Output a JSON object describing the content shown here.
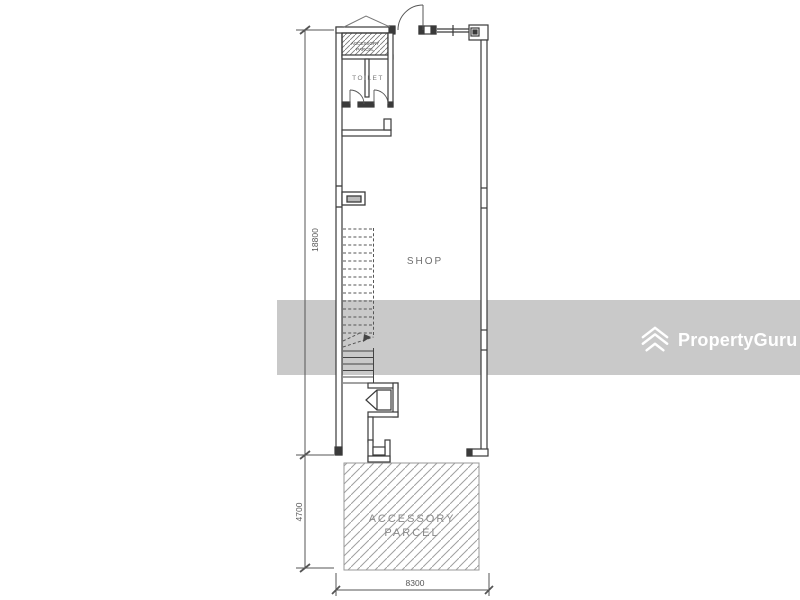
{
  "watermark": {
    "brand": "PropertyGuru",
    "band_color": "#c9c9c9",
    "logo_color": "#ffffff"
  },
  "plan": {
    "labels": {
      "shop": "SHOP",
      "toilet": "TOILET",
      "accessory_top": {
        "line1": "ACCESSORY",
        "line2": "PARCEL"
      },
      "accessory_bottom": {
        "line1": "ACCESSORY",
        "line2": "PARCEL"
      }
    },
    "dimensions": {
      "height_main": "18800",
      "height_accessory": "4700",
      "width": "8300"
    },
    "colors": {
      "wall_line": "#3a3a3a",
      "dimension_line": "#555555",
      "hatch": "#a0a0a0",
      "label_text": "#6e6e6e"
    }
  }
}
